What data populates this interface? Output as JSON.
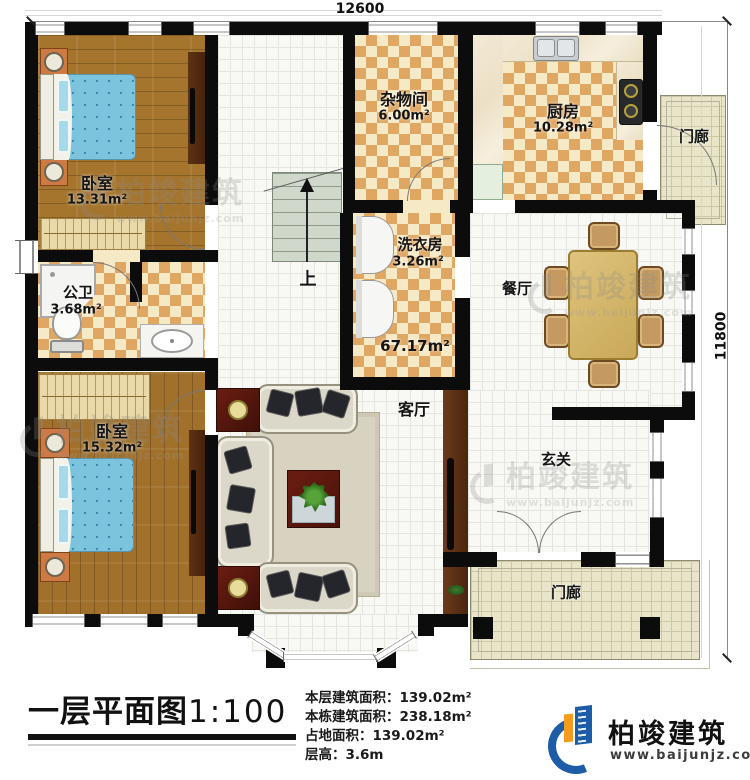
{
  "dims": {
    "width": "12600",
    "height": "11800"
  },
  "rooms": {
    "bedroom_top": {
      "name": "卧室",
      "area": "13.31m²"
    },
    "storage": {
      "name": "杂物间",
      "area": "6.00m²"
    },
    "kitchen": {
      "name": "厨房",
      "area": "10.28m²"
    },
    "porch_top": {
      "name": "门廊"
    },
    "laundry": {
      "name": "洗衣房",
      "area": "3.26m²"
    },
    "bathroom": {
      "name": "公卫",
      "area": "3.68m²"
    },
    "dining": {
      "name": "餐厅"
    },
    "living": {
      "name": "客厅"
    },
    "living_zone": {
      "area": "67.17m²"
    },
    "bedroom_bottom": {
      "name": "卧室",
      "area": "15.32m²"
    },
    "entry": {
      "name": "玄关"
    },
    "porch_bottom": {
      "name": "门廊"
    },
    "stairs": {
      "label": "上"
    }
  },
  "title_block": {
    "title": "一层平面图",
    "scale": "1:100",
    "stats": [
      {
        "label": "本层建筑面积：",
        "value": "139.02m²"
      },
      {
        "label": "本栋建筑面积：",
        "value": "238.18m²"
      },
      {
        "label": "占地面积：",
        "value": "139.02m²"
      },
      {
        "label": "层高：",
        "value": "3.6m"
      }
    ]
  },
  "brand": {
    "name": "柏竣建筑",
    "website": "www.baijunjz.com"
  },
  "watermark": {
    "name": "柏竣建筑",
    "website": "www.baijunjz.com"
  },
  "colors": {
    "wall": "#0c0c0c",
    "checker_tile": "#e0a763",
    "wood_floor": "#a5752e",
    "brand_blue": "#1d5ca6",
    "brand_orange": "#f59b1e"
  }
}
